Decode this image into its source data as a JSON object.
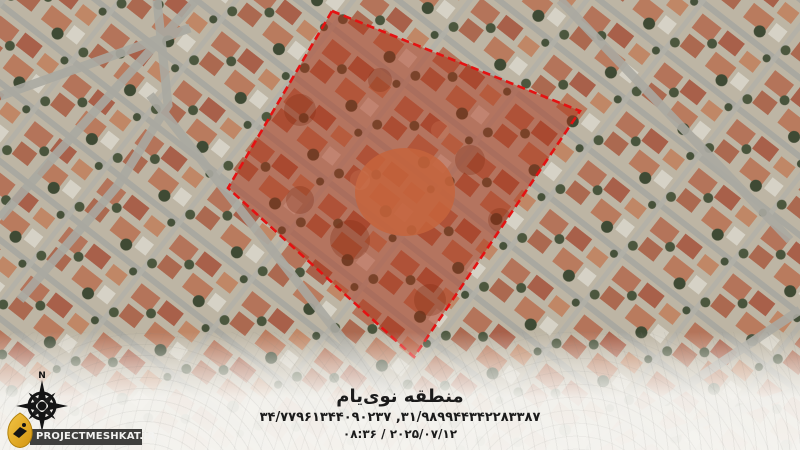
{
  "caption": {
    "title": "منطقه نوی‌یام",
    "coordinates": "۳۴/۷۷۹۶۱۳۴۴۰۹۰۲۳۷ ,۳۱/۹۸۹۹۴۴۳۴۲۲۸۳۳۸۷",
    "datetime": "۰۸:۳۶ / ۲۰۲۵/۰۷/۱۲"
  },
  "watermark": {
    "site_label": "PROJECTMESHKAT.IR",
    "north_label": "N"
  },
  "colors": {
    "region_outline": "#e41212",
    "region_fill": "rgba(186,44,18,0.34)",
    "strip_background": "#3f3f3d",
    "logo_gold": "#e5a91c"
  }
}
